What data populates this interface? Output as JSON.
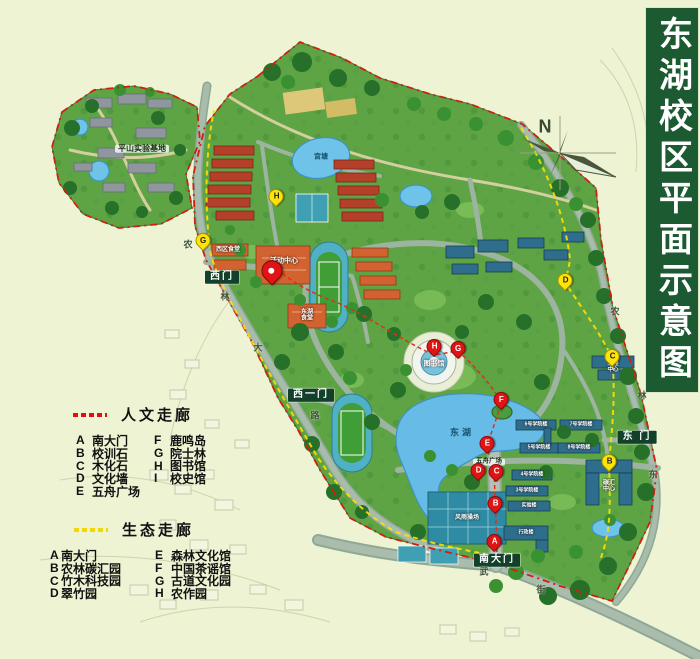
{
  "title": {
    "text": "东湖校区平面示意图"
  },
  "compass": {
    "label": "N"
  },
  "legends": {
    "humanities": {
      "title": "人文走廊",
      "dash_color": "#dd1111",
      "col1": [
        {
          "letter": "A",
          "label": "南大门"
        },
        {
          "letter": "B",
          "label": "校训石"
        },
        {
          "letter": "C",
          "label": "木化石"
        },
        {
          "letter": "D",
          "label": "文化墙"
        },
        {
          "letter": "E",
          "label": "五舟广场"
        }
      ],
      "col2": [
        {
          "letter": "F",
          "label": "鹿鸣岛"
        },
        {
          "letter": "G",
          "label": "院士林"
        },
        {
          "letter": "H",
          "label": "图书馆"
        },
        {
          "letter": "I",
          "label": "校史馆"
        }
      ]
    },
    "ecology": {
      "title": "生态走廊",
      "dash_color": "#f2d60a",
      "col1": [
        {
          "letter": "A",
          "label": "南大门"
        },
        {
          "letter": "B",
          "label": "农林碳汇园"
        },
        {
          "letter": "C",
          "label": "竹木科技园"
        },
        {
          "letter": "D",
          "label": "翠竹园"
        }
      ],
      "col2": [
        {
          "letter": "E",
          "label": "森林文化馆"
        },
        {
          "letter": "F",
          "label": "中国茶谣馆"
        },
        {
          "letter": "G",
          "label": "古道文化园"
        },
        {
          "letter": "H",
          "label": "农作园"
        }
      ]
    }
  },
  "gates": {
    "west": "西门",
    "west_one": "西一门",
    "east": "东 门",
    "south": "南大门"
  },
  "places": {
    "pingshan": "平山实验基地",
    "gongtang": "宫塘",
    "donghu": "东湖",
    "activity_center": "活动中心",
    "west_canteen": "西区食堂",
    "donghu_canteen": "东湖食堂",
    "library": "图书馆",
    "wuzhou_square": "五舟广场",
    "indoor_gym": "风雨操场",
    "carbon_center": "碳汇中心",
    "engineering_center": "工程中心",
    "admin": "行政楼",
    "lab": "实验楼",
    "colleges": [
      "6号学院楼",
      "7号学院楼",
      "5号学院楼",
      "8号学院楼",
      "4号学院楼",
      "3号学院楼"
    ]
  },
  "roads": {
    "west": [
      "农",
      "林",
      "大",
      "路"
    ],
    "east": [
      "农",
      "林",
      "东"
    ],
    "south": [
      "武",
      "街"
    ]
  },
  "markers": {
    "red": [
      "A",
      "B",
      "C",
      "D",
      "E",
      "F",
      "G",
      "H"
    ],
    "yellow": [
      "B",
      "C",
      "D",
      "G",
      "H"
    ]
  },
  "colors": {
    "banner": "#1c5a32",
    "campus_green": "#5ea344",
    "water": "#6fc2e8",
    "marker_red": "#e01414",
    "marker_yellow": "#ffe40a",
    "humanities_dash": "#dd1111",
    "ecology_dash": "#f2d60a"
  }
}
